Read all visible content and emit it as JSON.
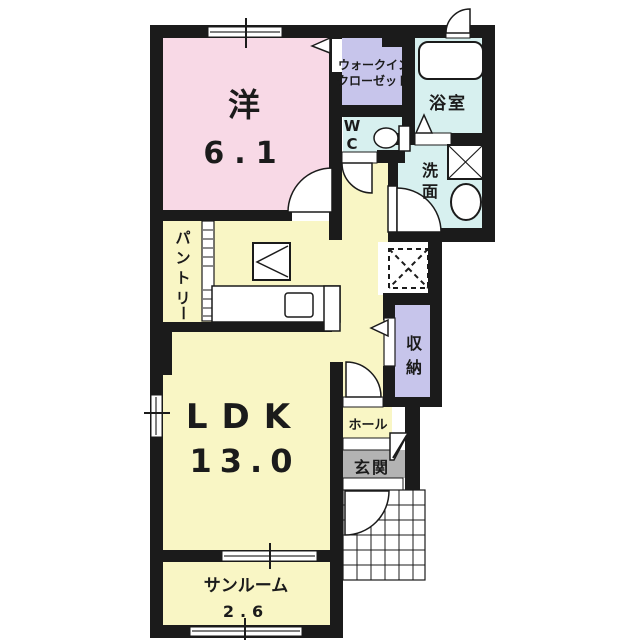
{
  "plan": {
    "type": "japanese-apartment-floor-plan",
    "colors": {
      "wall": "#1b1b1b",
      "bedroom_pink": "#f8d9e6",
      "ldk_yellow": "#f9f6c5",
      "closet_lavender": "#c7c5eb",
      "wet_cyan": "#d7f0ef",
      "entrance_gray": "#b3b3b3",
      "floor_white": "#ffffff"
    },
    "rooms": {
      "bedroom": {
        "name": "洋",
        "area": "6.1"
      },
      "walkin_closet": {
        "line1": "ウォークイン",
        "line2": "クローゼット"
      },
      "bathroom": {
        "name": "浴室"
      },
      "wc": {
        "chars": [
          "W",
          "C"
        ]
      },
      "washroom": {
        "chars": [
          "洗",
          "面"
        ]
      },
      "pantry": {
        "chars": [
          "パ",
          "ン",
          "ト",
          "リ",
          "ー"
        ]
      },
      "ldk": {
        "name": "LDK",
        "area": "13.0"
      },
      "storage": {
        "chars": [
          "収",
          "納"
        ]
      },
      "hall": {
        "name": "ホール"
      },
      "entrance": {
        "name": "玄関"
      },
      "sunroom": {
        "name": "サンルーム",
        "area": "2.6"
      }
    }
  }
}
